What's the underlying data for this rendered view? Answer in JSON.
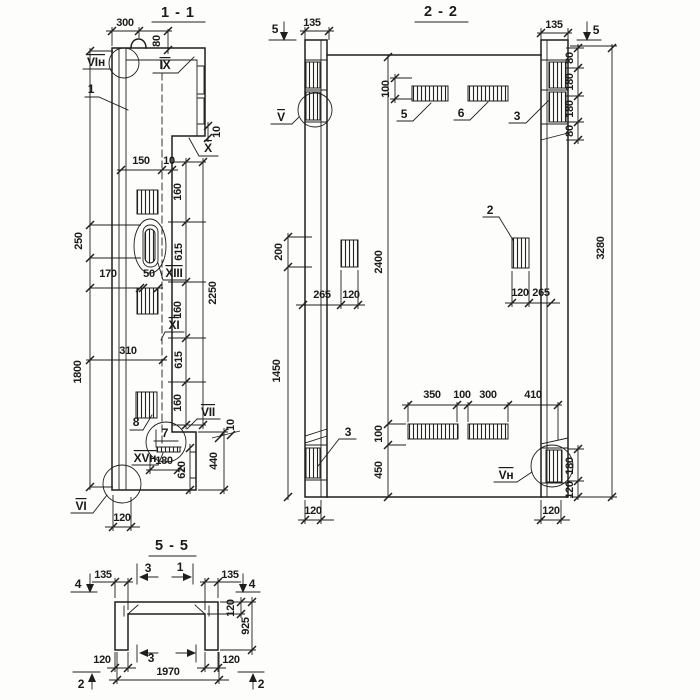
{
  "s11": {
    "title": "1 - 1",
    "dims": {
      "d300": "300",
      "d80": "80",
      "d250": "250",
      "d1800": "1800",
      "d170": "170",
      "d50": "50",
      "d150": "150",
      "d10_step": "10",
      "d310": "310",
      "d160a": "160",
      "d615a": "615",
      "d160b": "160",
      "d615b": "615",
      "d160c": "160",
      "d2250": "2250",
      "d10_x": "10",
      "d10_vii": "10",
      "d440": "440",
      "d620": "620",
      "d180": "180",
      "d120": "120"
    },
    "labels": {
      "vi_n": "VIн",
      "p1": "1",
      "ix": "IX",
      "x": "X",
      "xiii": "XIII",
      "xi": "XI",
      "p8": "8",
      "p7": "7",
      "xv_n": "XVн",
      "vii": "VII",
      "vi": "VI"
    }
  },
  "s22": {
    "title": "2 - 2",
    "dims": {
      "d135l": "135",
      "d135r": "135",
      "d80t": "80",
      "d180t": "180",
      "d180b": "180",
      "d80b": "80",
      "d3280": "3280",
      "d100t": "100",
      "d265l": "265",
      "d120l": "120",
      "d120r": "120",
      "d265r": "265",
      "d2400": "2400",
      "d100b": "100",
      "d450": "450",
      "d200": "200",
      "d1450": "1450",
      "d350": "350",
      "d100m": "100",
      "d300": "300",
      "d410": "410",
      "d180r": "180",
      "d120rb": "120",
      "d120fl": "120",
      "d120fr": "120"
    },
    "labels": {
      "cut5l": "5",
      "cut5r": "5",
      "v": "V",
      "v_n": "Vн",
      "p5": "5",
      "p6": "6",
      "p3l": "3",
      "p3r": "3",
      "p2": "2"
    }
  },
  "s55": {
    "title": "5 - 5",
    "dims": {
      "d135l": "135",
      "d135r": "135",
      "d120t": "120",
      "d925": "925",
      "d120bl": "120",
      "d120br": "120",
      "d1970": "1970"
    },
    "labels": {
      "cut4l": "4",
      "cut4r": "4",
      "cut3t": "3",
      "cut1t": "1",
      "cut3b": "3",
      "cut2l": "2",
      "cut2r": "2"
    }
  }
}
